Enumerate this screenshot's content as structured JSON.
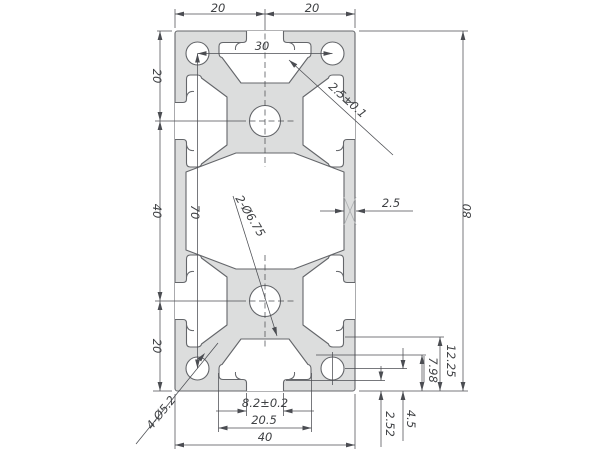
{
  "drawing": {
    "title": "aluminum-extrusion-40x80-cross-section",
    "type": "technical-dimension-drawing",
    "colors": {
      "profile_fill": "#dcdddd",
      "profile_line": "#64666a",
      "dim_line": "#4b4d52",
      "text": "#3f4144",
      "mark": "#aeb0b2"
    },
    "dimension_values": [
      "20",
      "20",
      "30",
      "20",
      "40",
      "20",
      "70",
      "80",
      "2.5",
      "2.5±0.1",
      "2-Ø6.75",
      "8.2±0.2",
      "20.5",
      "40",
      "12.25",
      "7.98",
      "4.5",
      "2.52",
      "4-Ø5.2"
    ]
  },
  "geometry": {
    "canvas": {
      "w": 600,
      "h": 450
    },
    "profile": {
      "x": 175,
      "y": 31,
      "w": 180,
      "h": 360,
      "rx": 2.5
    },
    "cavity_path": "M186,172 L236,153 L294,153 L344,172 L344,250 L294,269 L236,269 L186,250 Z",
    "slot_path": "M -18.5,0 L -18.5,8 Q -18.5,11.5 -22,11.5 L -42,11.5 Q -46,11.5 -46,15.5 L -46,22 Q -46,26 -43,26.5 L -24,52 L 24,52 L 43,26.5 Q 46,26 46,22 L 46,15.5 Q 46,11.5 42,11.5 L 22,11.5 Q 18.5,11.5 18.5,8 L 18.5,0",
    "slot_hooks": [
      "M-24,11.5 C-28.5,12.5 -30,15 -29.5,19",
      "M24,11.5 C28.5,12.5 30,15 29.5,19"
    ],
    "slot_transforms": [
      [
        1,
        0,
        0,
        1,
        265,
        31
      ],
      [
        1,
        0,
        0,
        -1,
        265,
        391
      ],
      [
        0,
        1,
        1,
        0,
        175,
        121
      ],
      [
        0,
        1,
        1,
        0,
        175,
        301
      ],
      [
        0,
        1,
        -1,
        0,
        355,
        121
      ],
      [
        0,
        1,
        -1,
        0,
        355,
        301
      ]
    ],
    "holes": [
      {
        "name": "corner-hole",
        "cx": 197.5,
        "cy": 53.5,
        "r": 11.5
      },
      {
        "name": "corner-hole",
        "cx": 332.5,
        "cy": 53.5,
        "r": 11.5
      },
      {
        "name": "corner-hole",
        "cx": 197.5,
        "cy": 368.5,
        "r": 11.5
      },
      {
        "name": "corner-hole",
        "cx": 332.5,
        "cy": 368.5,
        "r": 11.5
      },
      {
        "name": "center-hole",
        "cx": 265,
        "cy": 121,
        "r": 15.5
      },
      {
        "name": "center-hole",
        "cx": 265,
        "cy": 301,
        "r": 15.5
      }
    ],
    "x_mark": [
      "M344,197 L356,225",
      "M344,225 L356,197"
    ],
    "ext_lines": [
      [
        157,
        31,
        172,
        31
      ],
      [
        359,
        31,
        468,
        31
      ],
      [
        153,
        391,
        172,
        391
      ],
      [
        359,
        391,
        468,
        391
      ],
      [
        175,
        9,
        175,
        28
      ],
      [
        265,
        9,
        265,
        24
      ],
      [
        355,
        9,
        355,
        28
      ],
      [
        175,
        394,
        175,
        449
      ],
      [
        355,
        394,
        355,
        449
      ],
      [
        246.5,
        393,
        246.5,
        416
      ],
      [
        283.5,
        393,
        283.5,
        416
      ],
      [
        218.5,
        373,
        218.5,
        432
      ],
      [
        311.5,
        373,
        311.5,
        432
      ],
      [
        345,
        337,
        444,
        337
      ],
      [
        316,
        355,
        426,
        355
      ],
      [
        345,
        368.5,
        407,
        368.5
      ],
      [
        286,
        380.5,
        385,
        380.5
      ],
      [
        424,
        356,
        424,
        382
      ],
      [
        155,
        121,
        240,
        121
      ],
      [
        155,
        301,
        240,
        301
      ],
      [
        332.5,
        352,
        332.5,
        385
      ]
    ],
    "dashed_lines": [
      [
        240,
        121,
        294,
        121
      ],
      [
        240,
        301,
        294,
        301
      ],
      [
        265,
        24,
        265,
        167
      ],
      [
        265,
        255,
        265,
        347
      ]
    ],
    "dimensions": [
      {
        "name": "dim-top-left-20",
        "label": "20",
        "lines": [
          [
            175,
            14,
            265,
            14
          ]
        ],
        "arrows": [
          [
            175,
            14,
            180
          ],
          [
            265,
            14,
            0
          ]
        ],
        "lx": 218,
        "ly": 12,
        "rot": 0
      },
      {
        "name": "dim-top-right-20",
        "label": "20",
        "lines": [
          [
            265,
            14,
            355,
            14
          ]
        ],
        "arrows": [
          [
            265,
            14,
            180
          ],
          [
            355,
            14,
            0
          ]
        ],
        "lx": 312,
        "ly": 12,
        "rot": 0
      },
      {
        "name": "dim-hole-spacing-30",
        "label": "30",
        "lines": [
          [
            197.5,
            53.5,
            332.5,
            53.5
          ]
        ],
        "arrows": [
          [
            197.5,
            53.5,
            180
          ],
          [
            332.5,
            53.5,
            0
          ]
        ],
        "lx": 262,
        "ly": 50,
        "rot": 0
      },
      {
        "name": "dim-left-20-top",
        "label": "20",
        "lines": [
          [
            160,
            31,
            160,
            121
          ]
        ],
        "arrows": [
          [
            160,
            31,
            270
          ],
          [
            160,
            121,
            90
          ]
        ],
        "lx": 153,
        "ly": 76,
        "rot": 90
      },
      {
        "name": "dim-left-40",
        "label": "40",
        "lines": [
          [
            160,
            121,
            160,
            301
          ]
        ],
        "arrows": [
          [
            160,
            121,
            270
          ],
          [
            160,
            301,
            90
          ]
        ],
        "lx": 153,
        "ly": 211,
        "rot": 90
      },
      {
        "name": "dim-left-20-bottom",
        "label": "20",
        "lines": [
          [
            160,
            301,
            160,
            391
          ]
        ],
        "arrows": [
          [
            160,
            301,
            270
          ],
          [
            160,
            391,
            90
          ]
        ],
        "lx": 153,
        "ly": 346,
        "rot": 90
      },
      {
        "name": "dim-70",
        "label": "70",
        "lines": [
          [
            197.5,
            53.5,
            197.5,
            368.5
          ]
        ],
        "arrows": [
          [
            197.5,
            53.5,
            270
          ],
          [
            197.5,
            368.5,
            90
          ]
        ],
        "lx": 191,
        "ly": 212,
        "rot": 90
      },
      {
        "name": "dim-height-80",
        "label": "80",
        "lines": [
          [
            463,
            31,
            463,
            391
          ]
        ],
        "arrows": [
          [
            463,
            31,
            270
          ],
          [
            463,
            391,
            90
          ]
        ],
        "lx": 471,
        "ly": 211,
        "rot": -90
      },
      {
        "name": "dim-slot-mouth",
        "label": "8.2±0.2",
        "lines": [
          [
            216,
            411,
            246.5,
            411
          ],
          [
            283.5,
            411,
            314,
            411
          ]
        ],
        "arrows": [
          [
            246.5,
            411,
            0
          ],
          [
            283.5,
            411,
            180
          ]
        ],
        "lx": 265,
        "ly": 407,
        "rot": 0
      },
      {
        "name": "dim-slot-cavity",
        "label": "20.5",
        "lines": [
          [
            218.5,
            428,
            311.5,
            428
          ]
        ],
        "arrows": [
          [
            218.5,
            428,
            180
          ],
          [
            311.5,
            428,
            0
          ]
        ],
        "lx": 264,
        "ly": 424,
        "rot": 0
      },
      {
        "name": "dim-width-40",
        "label": "40",
        "lines": [
          [
            175,
            445,
            355,
            445
          ]
        ],
        "arrows": [
          [
            175,
            445,
            180
          ],
          [
            355,
            445,
            0
          ]
        ],
        "lx": 265,
        "ly": 441,
        "rot": 0
      },
      {
        "name": "dim-12-25",
        "label": "12.25",
        "lines": [
          [
            440,
            337,
            440,
            391
          ]
        ],
        "arrows": [
          [
            440,
            337,
            270
          ],
          [
            440,
            391,
            90
          ]
        ],
        "lx": 447,
        "ly": 361,
        "rot": 90
      },
      {
        "name": "dim-7-98",
        "label": "7.98",
        "lines": [
          [
            422,
            355,
            422,
            391
          ]
        ],
        "arrows": [
          [
            422,
            355,
            270
          ],
          [
            422,
            391,
            90
          ]
        ],
        "lx": 429,
        "ly": 370,
        "rot": 90
      },
      {
        "name": "dim-4-5",
        "label": "4.5",
        "lines": [
          [
            403,
            348,
            403,
            369
          ],
          [
            403,
            391,
            403,
            441
          ]
        ],
        "arrows": [
          [
            403,
            369,
            90
          ],
          [
            403,
            391,
            270
          ]
        ],
        "lx": 407,
        "ly": 419,
        "rot": 90
      },
      {
        "name": "dim-2-52",
        "label": "2.52",
        "lines": [
          [
            381,
            366,
            381,
            380.5
          ],
          [
            381,
            391,
            381,
            447
          ]
        ],
        "arrows": [
          [
            381,
            380.5,
            90
          ],
          [
            381,
            391,
            270
          ]
        ],
        "lx": 386,
        "ly": 424,
        "rot": 90
      },
      {
        "name": "dim-wall-2-5",
        "label": "2.5",
        "lines": [
          [
            320,
            211,
            344,
            211
          ],
          [
            356,
            211,
            413,
            211
          ]
        ],
        "arrows": [
          [
            344,
            211,
            0
          ],
          [
            356,
            211,
            180
          ]
        ],
        "lx": 391,
        "ly": 207,
        "rot": 0
      },
      {
        "name": "dim-lip-2-5",
        "label": "2.5±0.1",
        "lines": [
          [
            289,
            60,
            393,
            155
          ]
        ],
        "arrows": [
          [
            289,
            60,
            222
          ]
        ],
        "lx": 345,
        "ly": 103,
        "rot": 42
      },
      {
        "name": "leader-2-holes",
        "label": "2-Ø6.75",
        "lines": [
          [
            233,
            196,
            277,
            336
          ]
        ],
        "arrows": [
          [
            277,
            336,
            72
          ]
        ],
        "lx": 247,
        "ly": 218,
        "rot": 59
      },
      {
        "name": "leader-4-holes",
        "label": "4-Ø5.2",
        "lines": [
          [
            136,
            444,
            218,
            343
          ]
        ],
        "arrows": [
          [
            205,
            353,
            -51
          ]
        ],
        "lx": 164,
        "ly": 415,
        "rot": -51
      }
    ]
  }
}
